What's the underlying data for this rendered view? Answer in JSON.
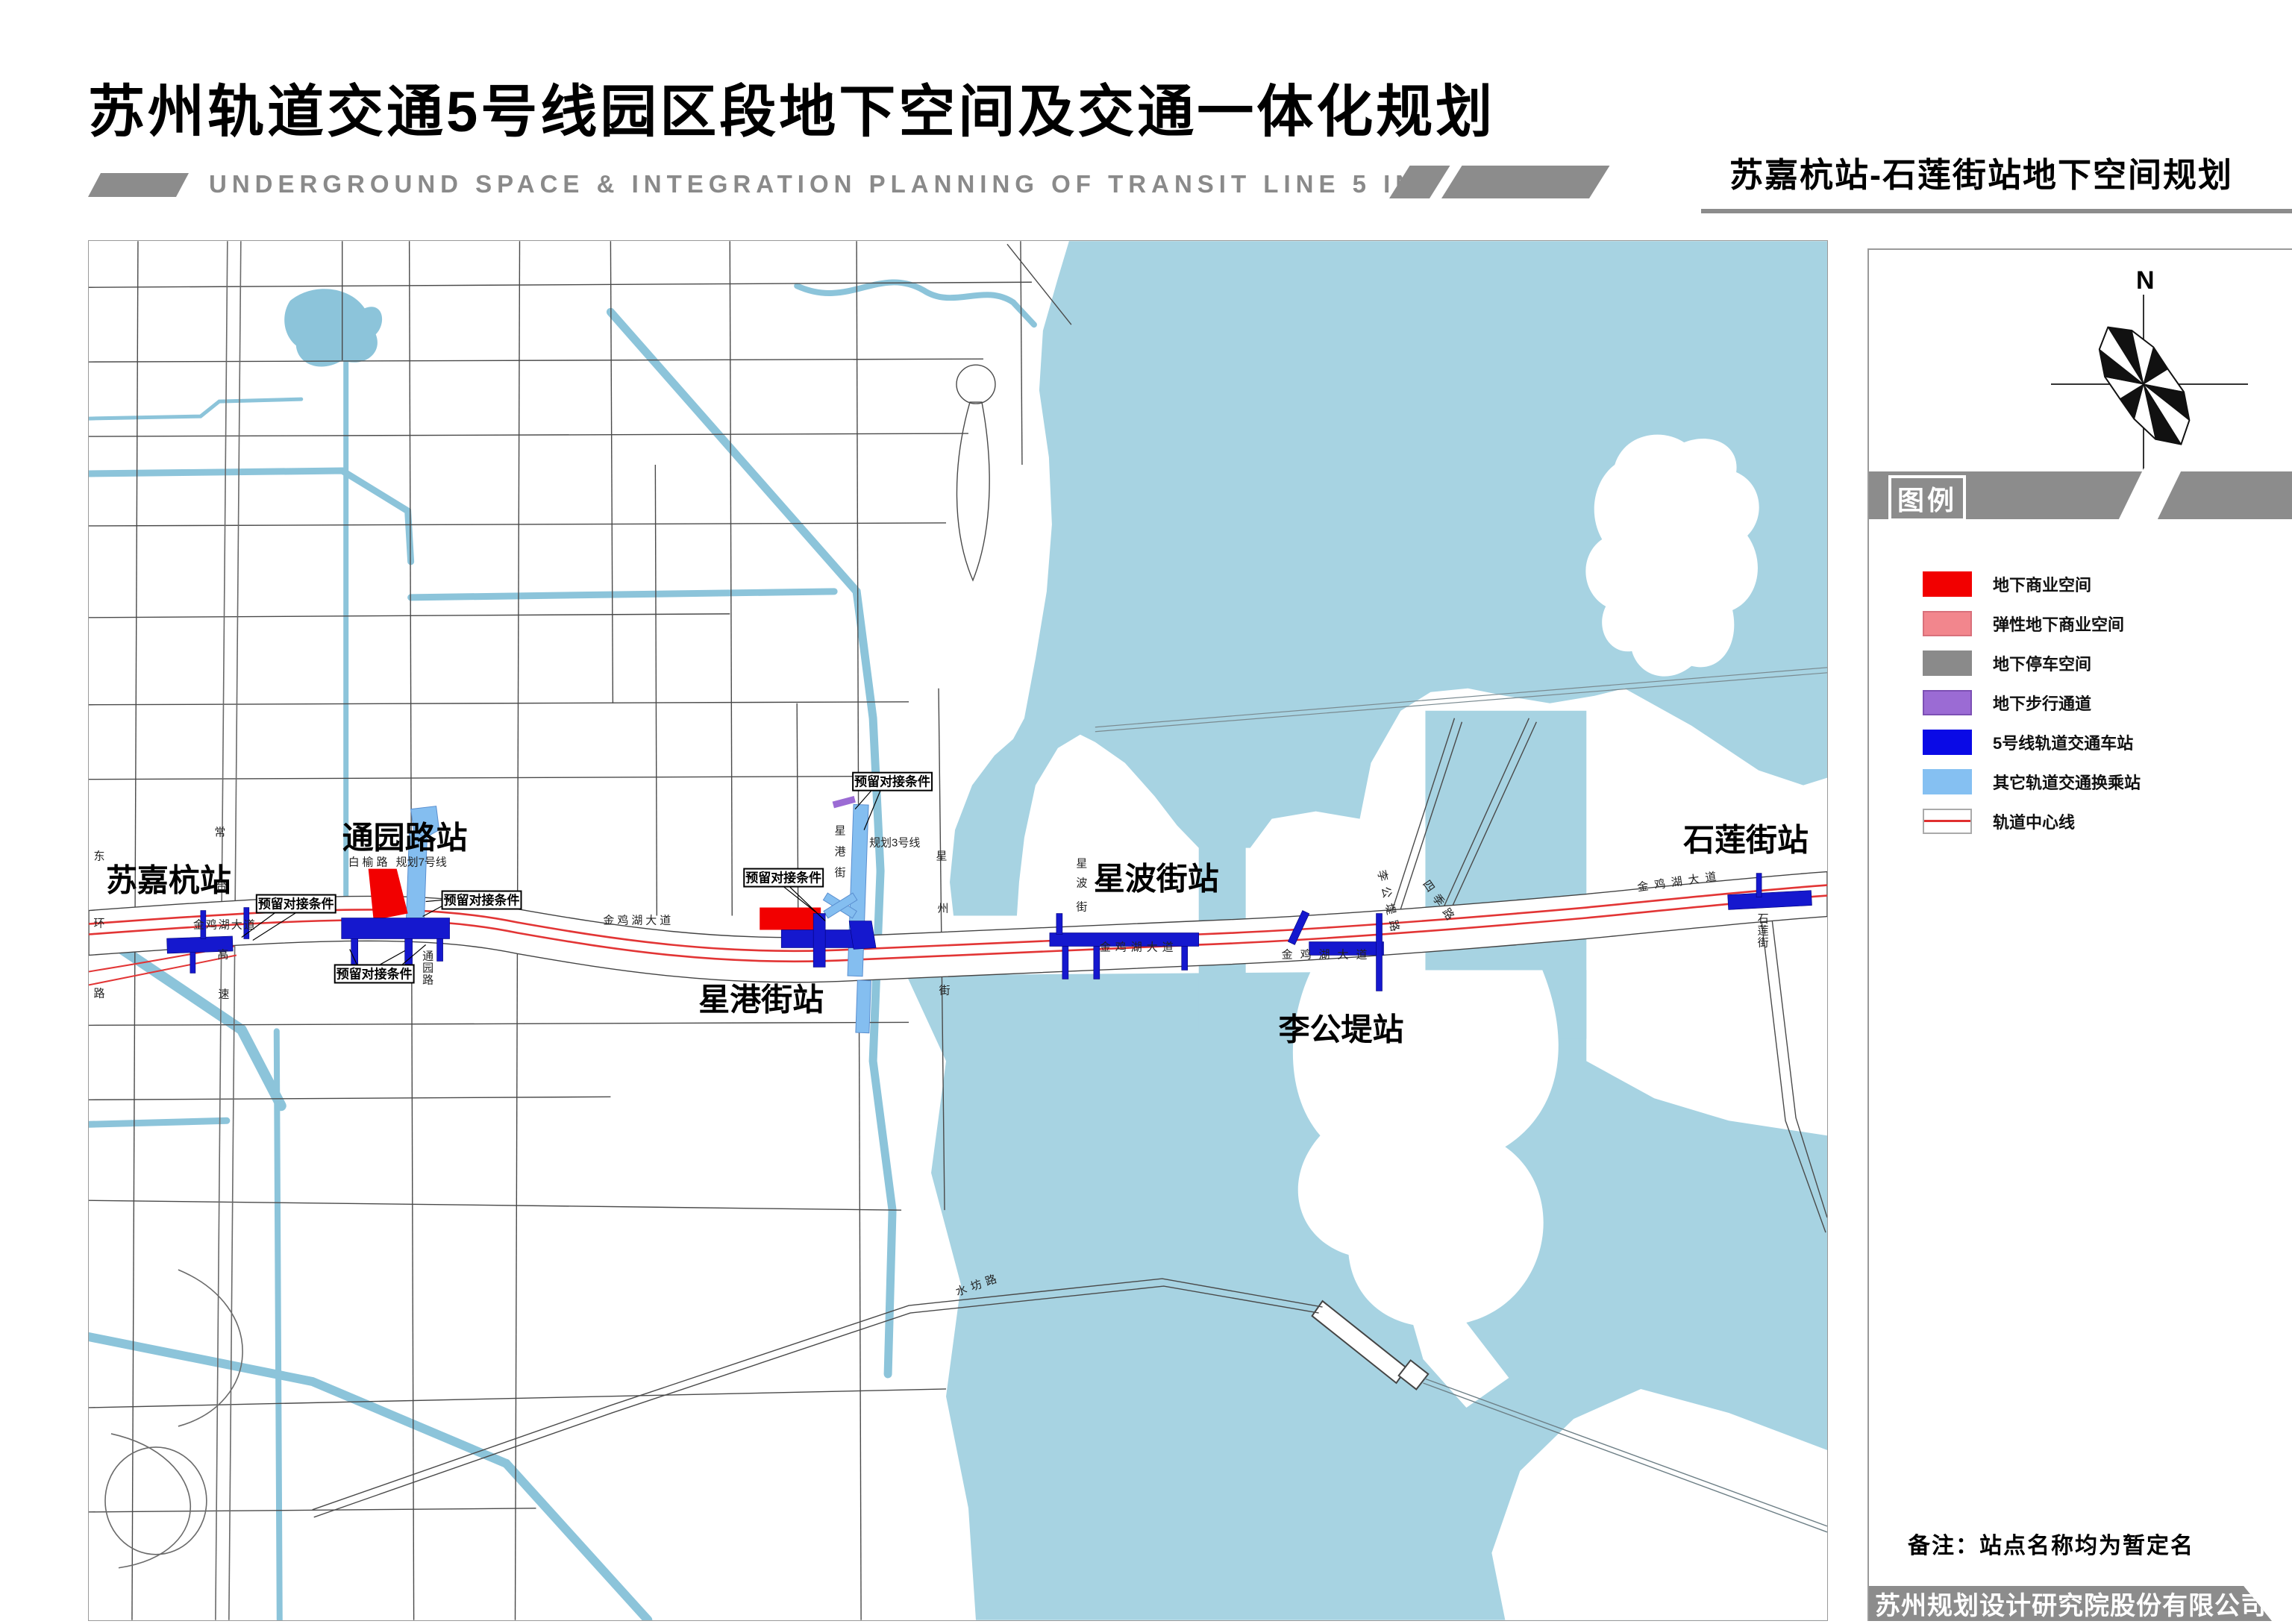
{
  "header": {
    "title": "苏州轨道交通5号线园区段地下空间及交通一体化规划",
    "subtitle": "UNDERGROUND SPACE & INTEGRATION PLANNING OF TRANSIT LINE 5 IN SIP",
    "sheet_title": "苏嘉杭站-石莲街站地下空间规划"
  },
  "compass": {
    "label": "N"
  },
  "legend": {
    "title": "图例",
    "items": [
      {
        "label": "地下商业空间",
        "color": "#f20000"
      },
      {
        "label": "弹性地下商业空间",
        "color": "#f2868d"
      },
      {
        "label": "地下停车空间",
        "color": "#8a8a8a"
      },
      {
        "label": "地下步行通道",
        "color": "#9b6bd4"
      },
      {
        "label": "5号线轨道交通车站",
        "color": "#0a0ae6"
      },
      {
        "label": "其它轨道交通换乘站",
        "color": "#85c0f2"
      },
      {
        "label": "轨道中心线",
        "color": "#e03030"
      }
    ]
  },
  "map": {
    "stations": [
      {
        "name": "苏嘉杭站"
      },
      {
        "name": "通园路站"
      },
      {
        "name": "星港街站"
      },
      {
        "name": "星波街站"
      },
      {
        "name": "李公堤站"
      },
      {
        "name": "石莲街站"
      }
    ],
    "annotation": "预留对接条件",
    "roads": {
      "donghuan": "东环路",
      "changtai": "常台高速",
      "jinjihu": "金鸡湖大道",
      "baiyu": "白榆路",
      "line7": "规划7号线",
      "line3": "规划3号线",
      "xinggang": "星港街",
      "xingzhou": "星州街",
      "xingbo": "星波街",
      "tongyuan": "通园路",
      "shilian": "石莲街",
      "ligongdi": "李公堤路",
      "siji": "四季路",
      "shuifang": "水坊路"
    },
    "colors": {
      "water": "#a7d3e2",
      "canal": "#8cc4da",
      "station_blue": "#1518ce",
      "interchange_blue": "#84bef0",
      "rail_center_line": "#e23535"
    }
  },
  "footer": {
    "note": "备注：站点名称均为暂定名",
    "company": "苏州规划设计研究院股份有限公司"
  }
}
